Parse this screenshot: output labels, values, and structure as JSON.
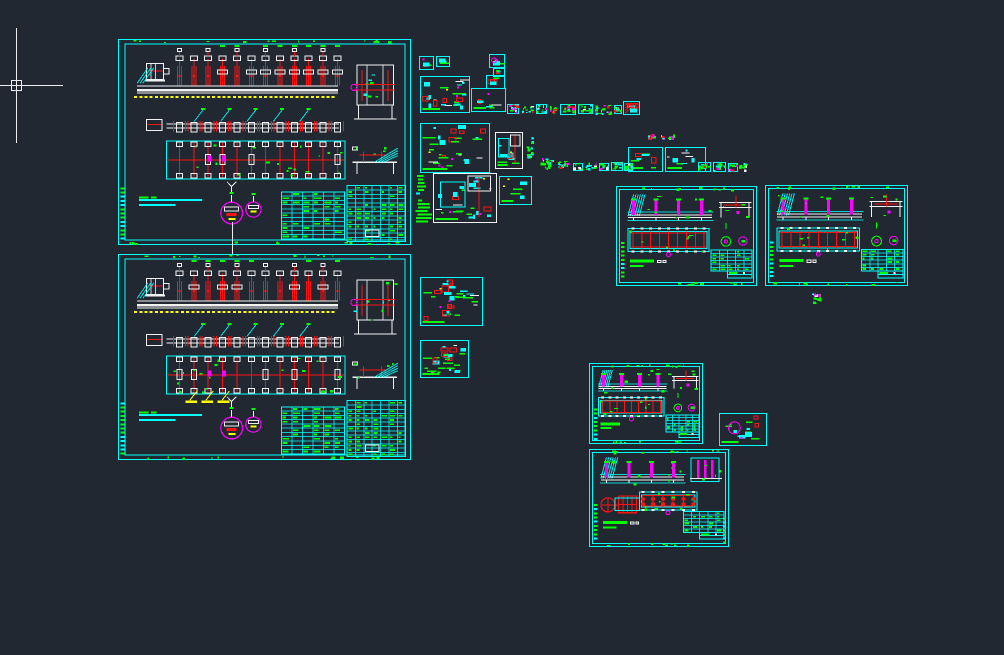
{
  "canvas": {
    "width": 1004,
    "height": 655,
    "background": "#222831"
  },
  "palette": {
    "cyan": "#00ffff",
    "green": "#00ff00",
    "red": "#ff1212",
    "magenta": "#ff00ff",
    "yellow": "#ffff00",
    "white": "#f2f2f2",
    "cursor": "#ededed"
  },
  "cursor": {
    "x": 16,
    "y": 85,
    "h_from": 0,
    "h_to": 63,
    "v_from": 28,
    "v_to": 143,
    "pickbox": 11
  },
  "connector": {
    "x": 232,
    "y1": 222,
    "y2": 254
  },
  "sheets": [
    {
      "id": "assembly-sheet-1",
      "type": "assembly",
      "x": 118,
      "y": 39,
      "w": 293,
      "h": 206,
      "seed": 7,
      "opts": {}
    },
    {
      "id": "assembly-sheet-2",
      "type": "assembly",
      "x": 118,
      "y": 254,
      "w": 293,
      "h": 206,
      "seed": 13,
      "opts": {
        "yellowMarks": true
      }
    },
    {
      "id": "conveyor-sheet-1",
      "type": "conveyor",
      "x": 616,
      "y": 186,
      "w": 141,
      "h": 100,
      "seed": 21,
      "opts": {}
    },
    {
      "id": "conveyor-sheet-2",
      "type": "conveyor",
      "x": 765,
      "y": 185,
      "w": 143,
      "h": 101,
      "seed": 22,
      "opts": {}
    },
    {
      "id": "conveyor-sheet-3",
      "type": "conveyor",
      "x": 589,
      "y": 363,
      "w": 114,
      "h": 81,
      "seed": 23,
      "opts": {}
    },
    {
      "id": "conveyor-sheet-4",
      "type": "conveyor",
      "x": 589,
      "y": 449,
      "w": 140,
      "h": 98,
      "seed": 24,
      "opts": {
        "xboxes": true
      }
    },
    {
      "id": "part-detail-1",
      "type": "detail",
      "x": 419,
      "y": 56,
      "w": 15,
      "h": 14,
      "seed": 31,
      "opts": {}
    },
    {
      "id": "part-detail-2",
      "type": "detail",
      "x": 436,
      "y": 56,
      "w": 14,
      "h": 11,
      "seed": 32,
      "opts": {}
    },
    {
      "id": "part-detail-3",
      "type": "detail",
      "x": 489,
      "y": 54,
      "w": 16,
      "h": 14,
      "seed": 33,
      "opts": {
        "magenta": true
      }
    },
    {
      "id": "part-detail-4",
      "type": "detail",
      "x": 493,
      "y": 68,
      "w": 12,
      "h": 9,
      "seed": 34,
      "opts": {}
    },
    {
      "id": "part-detail-5",
      "type": "detail",
      "x": 486,
      "y": 75,
      "w": 19,
      "h": 14,
      "seed": 35,
      "opts": {}
    },
    {
      "id": "part-detail-6",
      "type": "detail",
      "x": 420,
      "y": 76,
      "w": 50,
      "h": 37,
      "seed": 36,
      "opts": {
        "dense": true
      }
    },
    {
      "id": "part-detail-7",
      "type": "detail",
      "x": 471,
      "y": 88,
      "w": 35,
      "h": 24,
      "seed": 37,
      "opts": {}
    },
    {
      "id": "part-detail-8",
      "type": "detail",
      "x": 623,
      "y": 101,
      "w": 17,
      "h": 14,
      "seed": 38,
      "opts": {
        "redhatch": true
      }
    },
    {
      "id": "part-detail-9",
      "type": "detail",
      "x": 420,
      "y": 123,
      "w": 70,
      "h": 50,
      "seed": 39,
      "opts": {
        "dense": true
      }
    },
    {
      "id": "part-detail-10",
      "type": "detail",
      "x": 495,
      "y": 132,
      "w": 28,
      "h": 37,
      "seed": 40,
      "opts": {
        "whiteBorder": true
      }
    },
    {
      "id": "part-detail-11",
      "type": "detail",
      "x": 628,
      "y": 147,
      "w": 35,
      "h": 25,
      "seed": 41,
      "opts": {}
    },
    {
      "id": "part-detail-12",
      "type": "detail",
      "x": 665,
      "y": 147,
      "w": 41,
      "h": 25,
      "seed": 42,
      "opts": {}
    },
    {
      "id": "part-detail-13",
      "type": "detail",
      "x": 433,
      "y": 173,
      "w": 64,
      "h": 50,
      "seed": 43,
      "opts": {
        "whiteBorder": true
      }
    },
    {
      "id": "part-detail-14",
      "type": "detail",
      "x": 499,
      "y": 176,
      "w": 33,
      "h": 29,
      "seed": 44,
      "opts": {}
    },
    {
      "id": "part-detail-15",
      "type": "detail",
      "x": 420,
      "y": 277,
      "w": 63,
      "h": 49,
      "seed": 45,
      "opts": {
        "dense": true
      }
    },
    {
      "id": "part-detail-16",
      "type": "detail",
      "x": 420,
      "y": 340,
      "w": 49,
      "h": 38,
      "seed": 46,
      "opts": {
        "dense": true
      }
    },
    {
      "id": "part-detail-17",
      "type": "detail",
      "x": 719,
      "y": 413,
      "w": 48,
      "h": 33,
      "seed": 47,
      "opts": {
        "magenta": true
      }
    },
    {
      "id": "text-blob-column",
      "type": "blob",
      "x": 415,
      "y": 174,
      "w": 18,
      "h": 52,
      "seed": 48,
      "opts": {}
    }
  ],
  "clusters": [
    {
      "x": 507,
      "y": 104,
      "w": 12,
      "h": 10,
      "seed": 61
    },
    {
      "x": 521,
      "y": 105,
      "w": 13,
      "h": 9,
      "seed": 62
    },
    {
      "x": 536,
      "y": 104,
      "w": 11,
      "h": 10,
      "seed": 63
    },
    {
      "x": 549,
      "y": 106,
      "w": 9,
      "h": 8,
      "seed": 64
    },
    {
      "x": 560,
      "y": 104,
      "w": 16,
      "h": 11,
      "seed": 65
    },
    {
      "x": 578,
      "y": 104,
      "w": 15,
      "h": 10,
      "seed": 66
    },
    {
      "x": 595,
      "y": 104,
      "w": 17,
      "h": 11,
      "seed": 67
    },
    {
      "x": 614,
      "y": 105,
      "w": 8,
      "h": 9,
      "seed": 68
    },
    {
      "x": 526,
      "y": 132,
      "w": 8,
      "h": 28,
      "seed": 69
    },
    {
      "x": 538,
      "y": 158,
      "w": 16,
      "h": 12,
      "seed": 70
    },
    {
      "x": 556,
      "y": 160,
      "w": 14,
      "h": 10,
      "seed": 71
    },
    {
      "x": 573,
      "y": 163,
      "w": 10,
      "h": 8,
      "seed": 72
    },
    {
      "x": 585,
      "y": 162,
      "w": 12,
      "h": 9,
      "seed": 73
    },
    {
      "x": 599,
      "y": 163,
      "w": 10,
      "h": 8,
      "seed": 74
    },
    {
      "x": 611,
      "y": 162,
      "w": 12,
      "h": 9,
      "seed": 75
    },
    {
      "x": 624,
      "y": 163,
      "w": 9,
      "h": 8,
      "seed": 76
    },
    {
      "x": 698,
      "y": 162,
      "w": 13,
      "h": 10,
      "seed": 77
    },
    {
      "x": 713,
      "y": 162,
      "w": 13,
      "h": 10,
      "seed": 78
    },
    {
      "x": 728,
      "y": 163,
      "w": 10,
      "h": 9,
      "seed": 79
    },
    {
      "x": 739,
      "y": 163,
      "w": 9,
      "h": 9,
      "seed": 80
    }
  ],
  "glyphs": [
    {
      "x": 648,
      "y": 133,
      "w": 9,
      "h": 7,
      "seed": 91
    },
    {
      "x": 660,
      "y": 134,
      "w": 5,
      "h": 6,
      "seed": 92
    },
    {
      "x": 667,
      "y": 134,
      "w": 8,
      "h": 7,
      "seed": 93
    },
    {
      "x": 812,
      "y": 291,
      "w": 10,
      "h": 14,
      "seed": 94
    }
  ]
}
